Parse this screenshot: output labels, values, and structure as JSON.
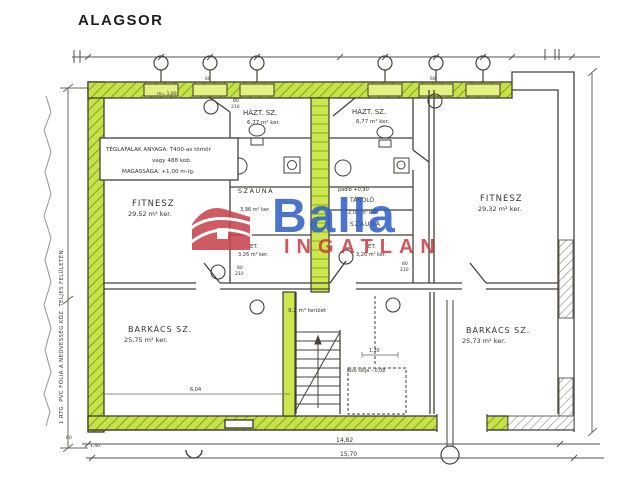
{
  "title": "ALAGSOR",
  "logo": {
    "brand": "Balla",
    "sub": "INGATLAN",
    "red": "#c7414b",
    "blue": "#2f5ec4"
  },
  "colors": {
    "wall_green": "#c6e248",
    "window_green": "#e3f183",
    "hatch_green": "#83a31f",
    "line": "#45413a"
  },
  "notes": {
    "materials_1": "TÉGLAFALAK ANYAGA: T400-as tömör",
    "materials_2": "vagy 488 kob.",
    "materials_3": "MAGASSÁGA: +1,00 m-ig.",
    "waterproof": "1 RTG. PVC FÓLIA A NEDVESSÉG KÖZ. TELJES FELÜLETÉN.",
    "corridor": "9,2 m² terület",
    "stair": "alsó síkja −0,08",
    "level": "padló +0,90"
  },
  "rooms": {
    "fitnesz_left": {
      "label": "FITNESZ",
      "area": "29,52 m² ker."
    },
    "fitnesz_right": {
      "label": "FITNESZ",
      "area": "29,32 m² ker."
    },
    "hazt_left": {
      "label": "HÁZT. SZ.",
      "area": "6,77 m² ker."
    },
    "hazt_right": {
      "label": "HÁZT. SZ.",
      "area": "6,77 m² ker."
    },
    "szauna_left": {
      "label": "SZAUNA",
      "area": "3,96 m² ker."
    },
    "tarolo": {
      "label": "TÁROLÓ",
      "area": "2,08 m² ker."
    },
    "szauna_right": {
      "label": "SZAUNA"
    },
    "et_left": {
      "label": "ET.",
      "area": "3,26 m² ker."
    },
    "et_right": {
      "label": "ET.",
      "area": "3,26 m² ker."
    },
    "barkacs_left": {
      "label": "BARKÁCS SZ.",
      "area": "25,75 m² ker."
    },
    "barkacs_right": {
      "label": "BARKÁCS SZ.",
      "area": "25,73 m² ker."
    }
  },
  "dims": {
    "total_inner": "14,82",
    "total_outer": "15,70",
    "d_604": "6,04",
    "d_130": "1,30",
    "d_60": "60",
    "d_140": "1,40",
    "sill": "m= 1,80",
    "door_w": "80",
    "door_h": "210"
  }
}
